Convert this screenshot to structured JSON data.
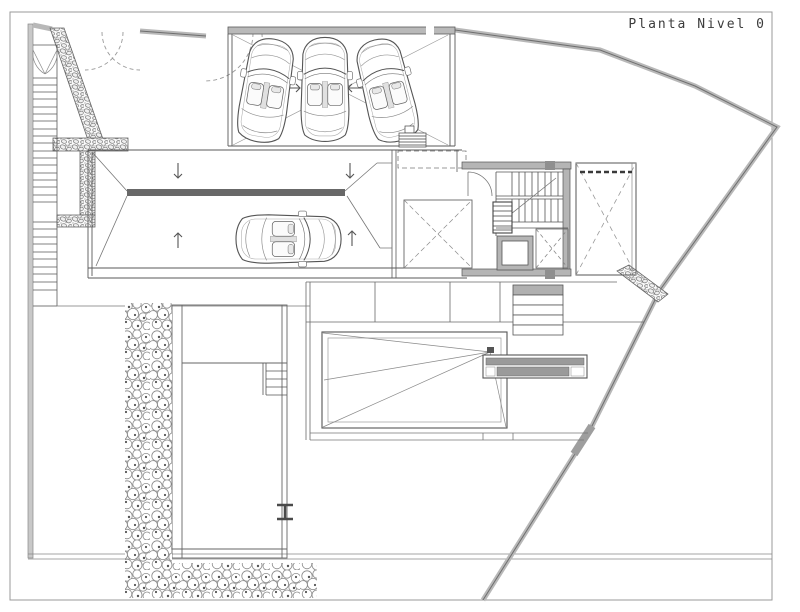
{
  "title": "Planta Nivel 0",
  "colors": {
    "background": "#ffffff",
    "line": "#4f4f4f",
    "light_line": "#919191",
    "wall_fill": "#b5b5b5",
    "dark_fill": "#686868",
    "boundary": "#b8b8b8"
  },
  "icons": {
    "ramp_flow": [
      "arrow-down-icon",
      "arrow-down-icon",
      "arrow-up-icon",
      "arrow-up-icon"
    ],
    "garage_flow": [
      "arrow-right-icon",
      "arrow-left-icon"
    ],
    "vehicles": [
      "car-top-view",
      "car-top-view",
      "car-top-view",
      "car-top-view"
    ]
  }
}
